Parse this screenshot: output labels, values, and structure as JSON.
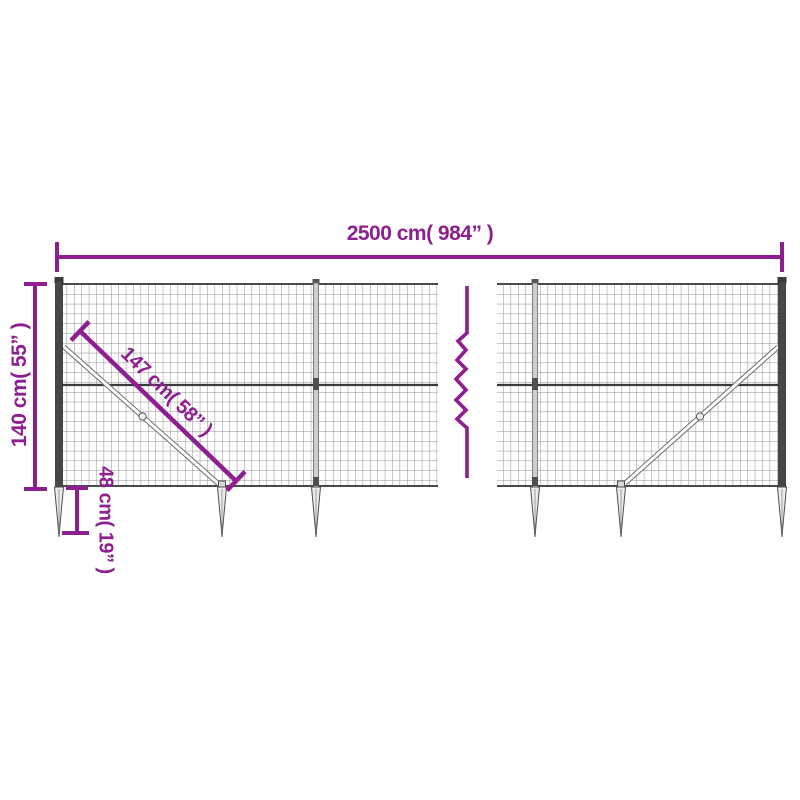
{
  "diagram": {
    "product": "wire-mesh-fence-with-ground-anchors",
    "dimensions": {
      "width": "2500 cm( 984” )",
      "height": "140 cm( 55” )",
      "diagonal": "147 cm( 58” )",
      "anchor_depth": "48 cm( 19” )"
    },
    "colors": {
      "dimension_accent": "#8d1f90",
      "mesh_wire": "#8f8f8f",
      "post_dark": "#474747",
      "post_light": "#cfcfcf"
    }
  }
}
